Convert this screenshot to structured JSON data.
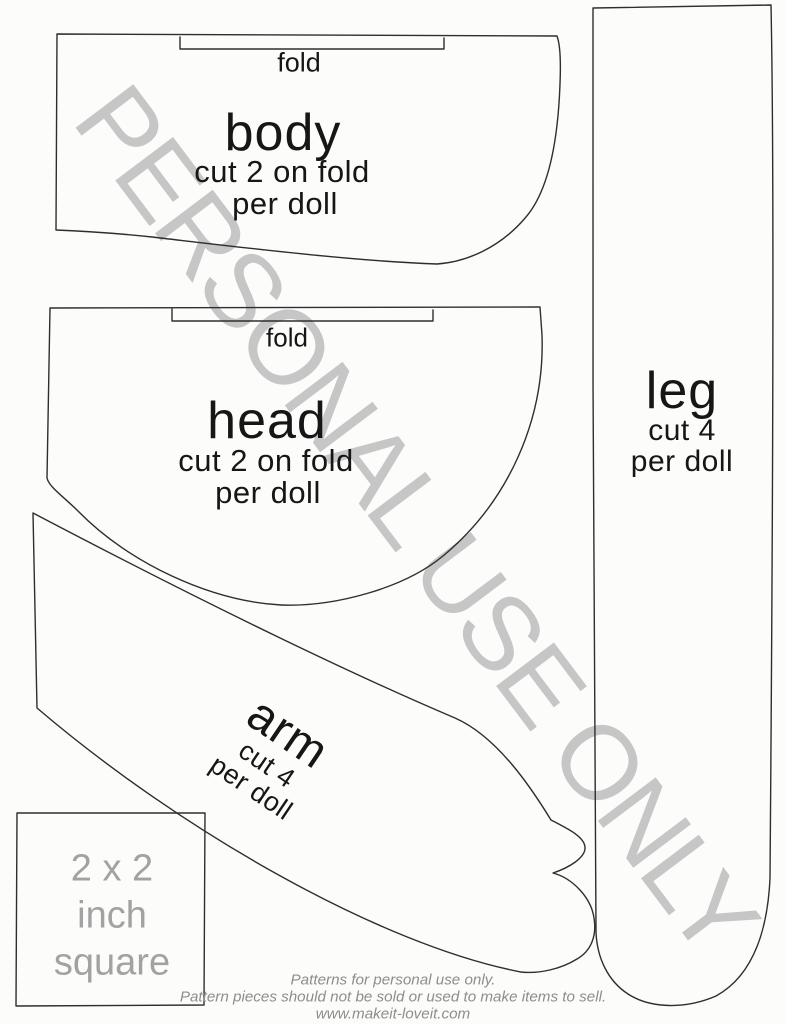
{
  "watermark": {
    "text": "PERSONAL USE ONLY",
    "color": "#c6c6c6"
  },
  "colors": {
    "ink_outline": "#2e2e2e",
    "ink_text": "#161616",
    "muted_gray": "#a2a2a2",
    "footer_gray": "#8d8d8d",
    "paper": "#fcfcfa"
  },
  "pieces": {
    "body": {
      "fold_label": "fold",
      "name": "body",
      "cut": "cut 2 on fold",
      "per": "per doll"
    },
    "head": {
      "fold_label": "fold",
      "name": "head",
      "cut": "cut 2 on fold",
      "per": "per doll"
    },
    "arm": {
      "name": "arm",
      "cut": "cut 4",
      "per": "per doll"
    },
    "leg": {
      "name": "leg",
      "cut": "cut 4",
      "per": "per doll"
    },
    "scale_square": {
      "line1": "2 x 2",
      "line2": "inch",
      "line3": "square"
    }
  },
  "footer": {
    "line1": "Patterns for personal use only.",
    "line2": "Pattern pieces should not be sold or used to make items to sell.",
    "line3": "www.makeit-loveit.com"
  }
}
